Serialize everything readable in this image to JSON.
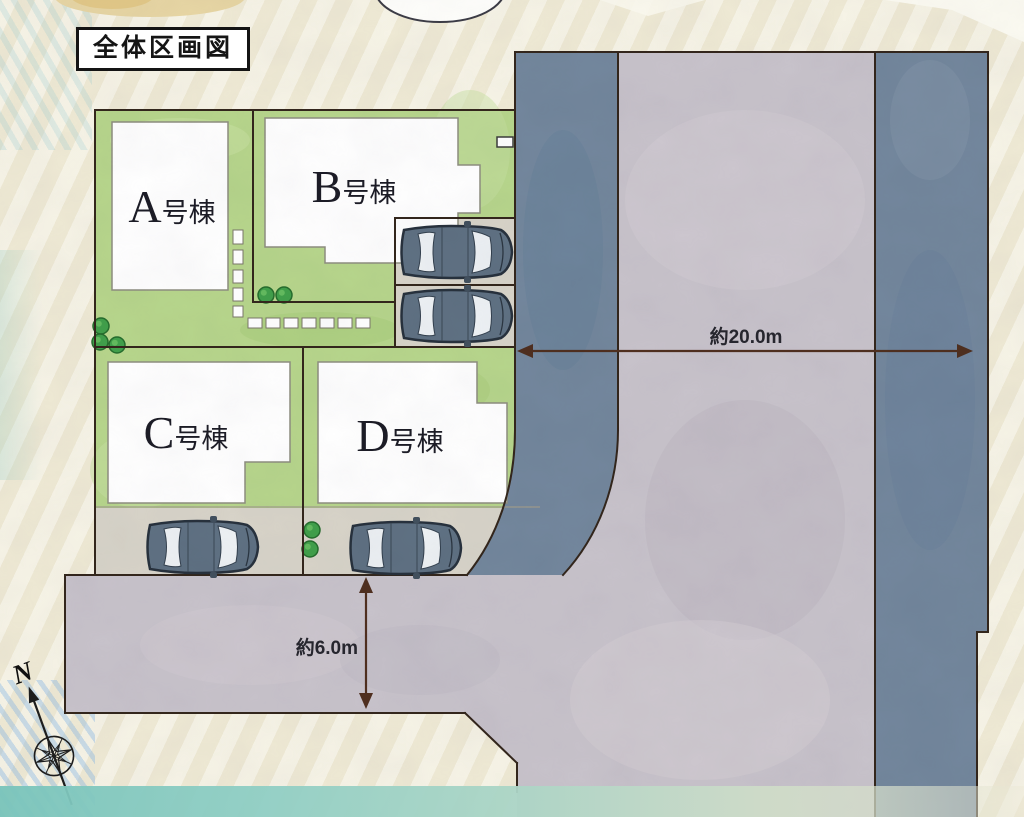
{
  "title": "全体区画図",
  "buildings": [
    {
      "id": "A",
      "letter": "A",
      "suffix": "号棟",
      "label": "A号棟"
    },
    {
      "id": "B",
      "letter": "B",
      "suffix": "号棟",
      "label": "B号棟"
    },
    {
      "id": "C",
      "letter": "C",
      "suffix": "号棟",
      "label": "C号棟"
    },
    {
      "id": "D",
      "letter": "D",
      "suffix": "号棟",
      "label": "D号棟"
    }
  ],
  "dimensions": {
    "main_road_width": "約20.0m",
    "side_road_width": "約6.0m"
  },
  "compass": {
    "north": "N"
  },
  "icons": {
    "compass": "compass-rose-icon",
    "car": "car-top-icon",
    "tree": "tree-icon"
  },
  "colors": {
    "background": "#f3efdc",
    "lot_green": "#b7d68c",
    "road": "#c8c3cb",
    "sidewalk": "#73879d",
    "pavement": "#d8d4c9",
    "outline": "#33261c",
    "building_fill": "#ffffff",
    "dimension_line": "#4f2f1f",
    "car_body": "#5f7183",
    "tree_green": "#41a04b",
    "band_teal": "#86c9bd"
  }
}
